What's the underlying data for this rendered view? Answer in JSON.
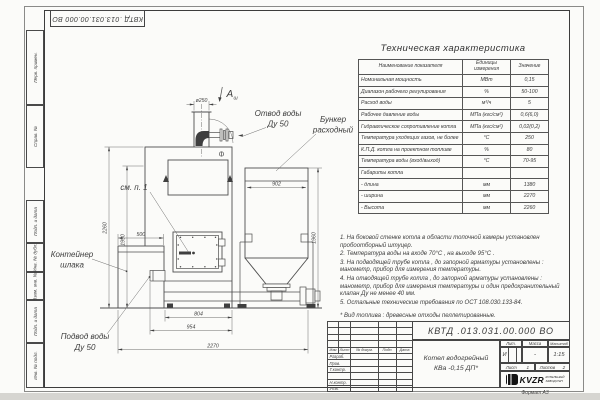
{
  "stamp_top": {
    "number": "КВТД .013.031.00.000  ВО"
  },
  "margins": {
    "perv": "Перв. примен.",
    "sprav": "Справ. №",
    "podp1": "Подп. и дата",
    "inv_dubl": "Инв. № дубл.",
    "vzam": "Взам. инв. №",
    "podp2": "Подп. и дата",
    "inv_podl": "Инв. № подл.",
    "format": "Формат А3"
  },
  "spec_table": {
    "title": "Техническая характеристика",
    "col_name": "Наименование показателя",
    "col_units": "Единицы измерения",
    "col_value": "Значение",
    "rows": [
      {
        "name": "Номинальная мощность",
        "units": "МВт",
        "value": "0,15"
      },
      {
        "name": "Диапазон рабочего регулирования",
        "units": "%",
        "value": "50-100"
      },
      {
        "name": "Расход воды",
        "units": "м³/ч",
        "value": "5"
      },
      {
        "name": "Рабочее давление воды",
        "units": "МПа (кгс/см²)",
        "value": "0,6(6,0)"
      },
      {
        "name": "Гидравлическое сопротивление котла",
        "units": "МПа (кгс/см²)",
        "value": "0,02(0,2)"
      },
      {
        "name": "Температура уходящих газов, не более",
        "units": "°С",
        "value": "250"
      },
      {
        "name": "К.П.Д. котла на проектном топливе",
        "units": "%",
        "value": "80"
      },
      {
        "name": "Температура воды (вход/выход)",
        "units": "°С",
        "value": "70-95"
      },
      {
        "name": "Габариты котла",
        "units": "",
        "value": ""
      },
      {
        "name": "- длина",
        "units": "мм",
        "value": "1380"
      },
      {
        "name": "- ширина",
        "units": "мм",
        "value": "2270"
      },
      {
        "name": "- Высота",
        "units": "мм",
        "value": "2260"
      }
    ]
  },
  "notes": [
    "1.  На боковой стенке котла в области топочной камеры установлен пробоотборный штуцер.",
    "2.  Температура воды на входе  70°С ,  на выходе  95°С .",
    "3.  На подводящей трубе котла , до запорной арматуры установлены : манометр, прибор для измерения температуры.",
    "4.  На отводящей трубе котла , до запорной арматуры установлены : манометр, прибор для измерения температуры и один предохранительный клапан  Ду не менее  40 мм.",
    "5.  Остальные технические требования по ОСТ  108.030.133-84."
  ],
  "fuel_note": "*  Вид топлива :  древесные отходы пеллетированные.",
  "drawing": {
    "view_label": "А",
    "view_sub": "ш",
    "dim_d250": "ø250",
    "dim_902": "902",
    "dim_500": "500",
    "dim_2260": "2260",
    "dim_1990": "1990",
    "dim_1960": "1960",
    "dim_804": "804",
    "dim_954": "954",
    "dim_2270": "2270",
    "label_otvod1": "Отвод воды",
    "label_otvod2": "Ду 50",
    "label_bunker1": "Бункер",
    "label_bunker2": "расходный",
    "label_see_note": "см. п. 1",
    "label_container1": "Контейнер",
    "label_container2": "шлака",
    "label_podvod1": "Подвод воды",
    "label_podvod2": "Ду 50"
  },
  "title_block": {
    "designation": "КВТД .013.031.00.000  ВО",
    "cols": [
      "Изм",
      "Лист",
      "№ докум.",
      "Подп.",
      "Дата"
    ],
    "rows": [
      "Разраб.",
      "Пров.",
      "Т.контр.",
      "",
      "Н.контр.",
      "Утв."
    ],
    "product_name1": "Котел водогрейный",
    "product_name2": "КВа -0,15  ДП*",
    "lit_label": "Лит.",
    "mass_label": "Масса",
    "scale_label": "Масштаб",
    "lit_value": "И",
    "mass_value": "-",
    "scale_value": "1:15",
    "sheet_label": "Лист",
    "sheet_value": "1",
    "sheets_label": "Листов",
    "sheets_value": "2",
    "logo": "KVZR",
    "logo_sub1": "КОТЕЛЬНЫЙ",
    "logo_sub2": "ЗАВОД РЭП"
  }
}
